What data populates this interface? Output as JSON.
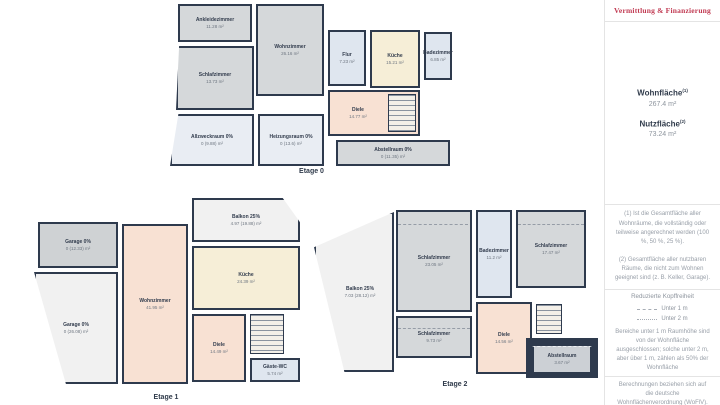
{
  "colors": {
    "wall": "#2e3a4d",
    "room_gray": "#d5d8da",
    "room_blue": "#dfe6ef",
    "room_cream": "#f6eed7",
    "room_peach": "#f8e1d3",
    "room_pale": "#e9edf3",
    "outdoor": "#f1f1f1",
    "logo_red": "#c13a52"
  },
  "floors": [
    {
      "label": "Etage 0",
      "rooms": [
        {
          "name": "Ankleidezimmer",
          "area": "11.28 m²"
        },
        {
          "name": "Wohnzimmer",
          "area": "26.16 m²"
        },
        {
          "name": "Schlafzimmer",
          "area": "13.73 m²"
        },
        {
          "name": "Flur",
          "area": "7.23 m²"
        },
        {
          "name": "Küche",
          "area": "15.21 m²"
        },
        {
          "name": "Badezimmer",
          "area": "6.85 m²"
        },
        {
          "name": "Diele",
          "area": "14.77 m²"
        },
        {
          "name": "Allzweckraum 0%",
          "area": "0 (9.88) m²"
        },
        {
          "name": "Heizungsraum 0%",
          "area": "0 (13.6) m²"
        },
        {
          "name": "Abstellraum 0%",
          "area": "0 (11.35) m²"
        }
      ]
    },
    {
      "label": "Etage 1",
      "rooms": [
        {
          "name": "Garage 0%",
          "area": "0 (12.33) m²"
        },
        {
          "name": "Garage 0%",
          "area": "0 (26.08) m²"
        },
        {
          "name": "Wohnzimmer",
          "area": "41.95 m²"
        },
        {
          "name": "Balkon 25%",
          "area": "4.97 (19.88) m²"
        },
        {
          "name": "Küche",
          "area": "24.39 m²"
        },
        {
          "name": "Diele",
          "area": "14.49 m²"
        },
        {
          "name": "Gäste-WC",
          "area": "5.74 m²"
        }
      ]
    },
    {
      "label": "Etage 2",
      "rooms": [
        {
          "name": "Balkon 25%",
          "area": "7.03 (28.12) m²"
        },
        {
          "name": "Schlafzimmer",
          "area": "23.05 m²"
        },
        {
          "name": "Badezimmer",
          "area": "11.2 m²"
        },
        {
          "name": "Schlafzimmer",
          "area": "17.47 m²"
        },
        {
          "name": "Schlafzimmer",
          "area": "9.73 m²"
        },
        {
          "name": "Diele",
          "area": "14.56 m²"
        },
        {
          "name": "Abstellraum",
          "area": "3.67 m²"
        }
      ]
    }
  ],
  "sidebar": {
    "logo_text": "Vermittlung & Finanzierung",
    "wohnflaeche_label": "Wohnfläche",
    "wohnflaeche_sup": "(1)",
    "wohnflaeche_value": "267.4 m²",
    "nutzflaeche_label": "Nutzfläche",
    "nutzflaeche_sup": "(2)",
    "nutzflaeche_value": "73.24 m²",
    "footnote_1": "(1) Ist die Gesamtfläche aller Wohnräume, die vollständig oder teilweise angerechnet werden (100 %, 50 %, 25 %).",
    "footnote_2": "(2) Gesamtfläche aller nutzbaren Räume, die nicht zum Wohnen geeignet sind (z. B. Keller, Garage).",
    "legend_title": "Reduzierte Kopffreiheit",
    "legend_item_1": "Unter 1 m",
    "legend_item_2": "Unter 2 m",
    "legend_note": "Bereiche unter 1 m Raumhöhe sind von der Wohnfläche ausgeschlossen; solche unter 2 m, aber über 1 m, zählen als 50% der Wohnfläche",
    "disclaimer": "Berechnungen beziehen sich auf die deutsche Wohnflächenverordnung (WoFlV). Maße sind ungefähre Angaben"
  }
}
